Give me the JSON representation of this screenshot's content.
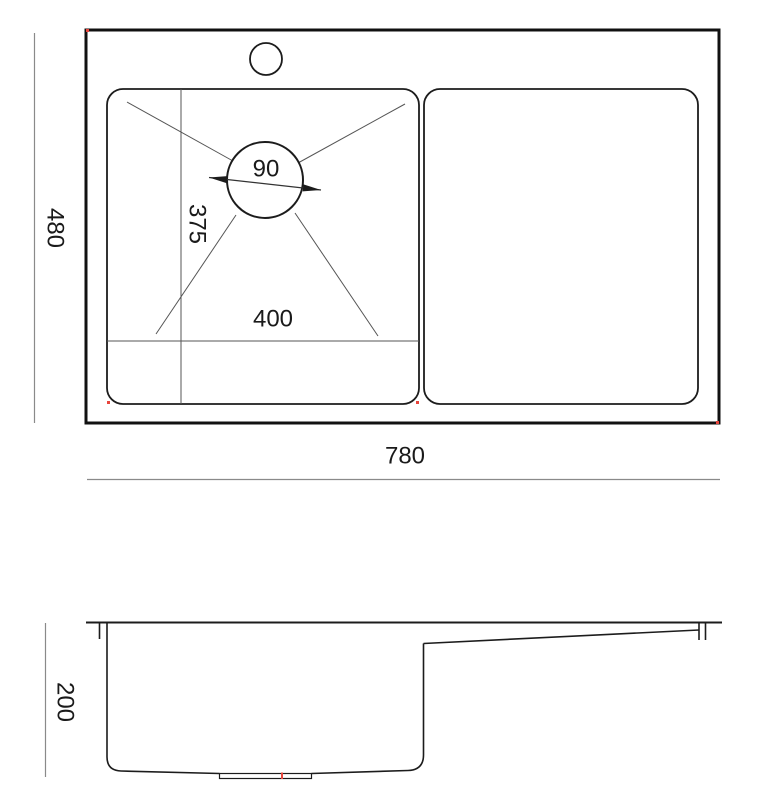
{
  "drawing": {
    "type": "technical-dimension-drawing",
    "subject": "kitchen sink with bowl, drainboard and faucet hole",
    "views": {
      "top": {
        "overall_width_label": "780",
        "overall_depth_label": "480",
        "bowl_width_label": "400",
        "bowl_depth_label": "375",
        "drain_diameter_label": "90"
      },
      "side": {
        "height_label": "200"
      }
    }
  },
  "colors": {
    "outline": "#1c1c1c",
    "thick_outline": "#111111",
    "thin_line": "#555555",
    "dim_line": "#8a8a8a",
    "marker_red": "#e8453c",
    "background": "#ffffff"
  }
}
